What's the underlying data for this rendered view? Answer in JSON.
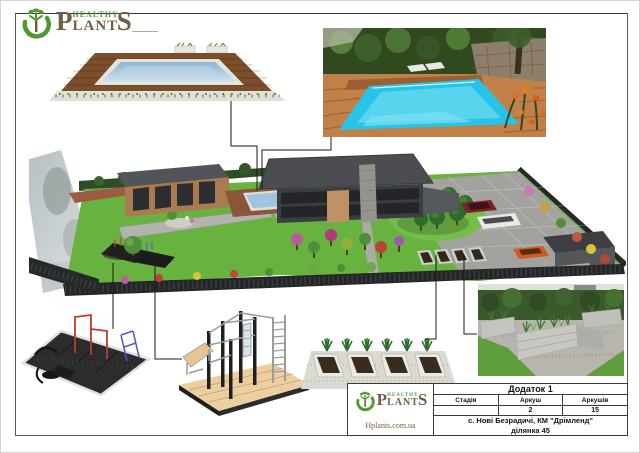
{
  "page": {
    "frame_color": "#5a5a5a",
    "background": "#ffffff"
  },
  "brand": {
    "healthy": "HEALTHY",
    "p": "P",
    "lant": "LANT",
    "s": "S",
    "website": "Hplants.com.ua",
    "green": "#4d9b2f",
    "brown": "#6f5f49"
  },
  "title_block": {
    "appendix": "Додаток 1",
    "col_stage": "Стадія",
    "col_sheet": "Аркуш",
    "col_sheets": "Аркушів",
    "stage_value": "",
    "sheet_value": "2",
    "sheets_value": "15",
    "location_line1": "с. Нові Безрадичі, КМ \"Дрімленд\"",
    "location_line2": "ділянка 45"
  },
  "figure_colors": {
    "lawn_green": "#68b340",
    "pool_water": "#9ec4e2",
    "photo_pool_water": "#28c3e8",
    "deck_brown": "#7b4e2c",
    "fence_dark": "#232527",
    "paving_gray": "#a2a29e",
    "bed_soil": "#33261a",
    "concrete_gray": "#c8c8c2",
    "callout_line": "#1a1a1a"
  }
}
